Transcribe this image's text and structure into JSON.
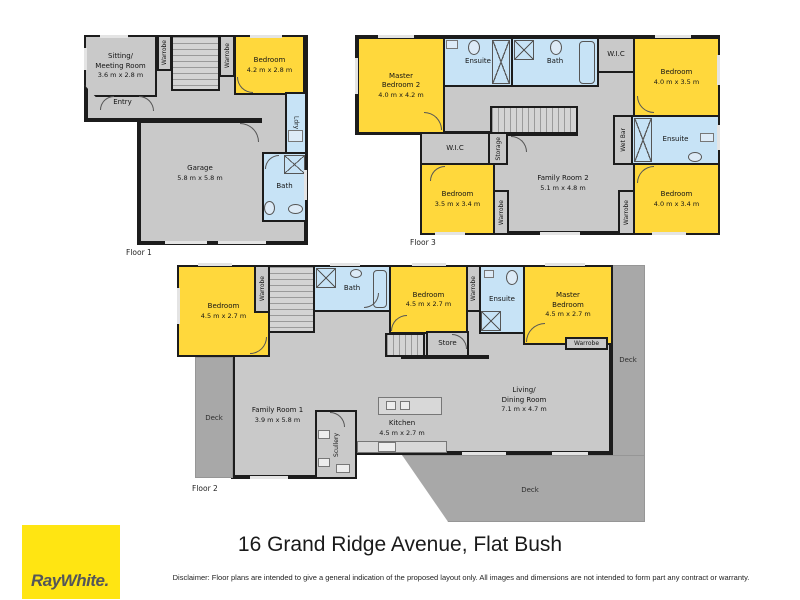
{
  "title": "16 Grand Ridge Avenue, Flat Bush",
  "disclaimer": "Disclaimer: Floor plans are intended to give a general indication of the proposed layout only. All images and dimensions are not intended to form part any contract or warranty.",
  "brand": {
    "logo_text": "RayWhite."
  },
  "colors": {
    "bedroom_yellow": "#FFD83C",
    "bath_blue": "#C7E3F6",
    "room_gray": "#C9C9C9",
    "deck_gray": "#A8A8A8",
    "wall_black": "#1C1C1C",
    "logo_yellow": "#FFE512",
    "logo_text_gray": "#54565A"
  },
  "floors": [
    {
      "label": "Floor 1",
      "rooms": {
        "sitting": {
          "name": "Sitting/\nMeeting Room",
          "dims": "3.6 m x 2.8 m"
        },
        "wardrobe_a": {
          "name": "Warrobe"
        },
        "wardrobe_b": {
          "name": "Warrobe"
        },
        "bedroom": {
          "name": "Bedroom",
          "dims": "4.2 m x 2.8 m"
        },
        "entry": {
          "name": "Entry"
        },
        "laundry": {
          "name": "Ldry"
        },
        "garage": {
          "name": "Garage",
          "dims": "5.8 m x 5.8 m"
        },
        "bath": {
          "name": "Bath"
        }
      }
    },
    {
      "label": "Floor 2",
      "rooms": {
        "bedroom_left": {
          "name": "Bedroom",
          "dims": "4.5 m x 2.7 m"
        },
        "wardrobe_left": {
          "name": "Warrobe"
        },
        "bath": {
          "name": "Bath"
        },
        "bedroom_mid": {
          "name": "Bedroom",
          "dims": "4.5 m x 2.7 m"
        },
        "wardrobe_mid": {
          "name": "Warrobe"
        },
        "ensuite": {
          "name": "Ensuite"
        },
        "master_bedroom": {
          "name": "Master\nBedroom",
          "dims": "4.5 m x 2.7 m"
        },
        "wardrobe_master": {
          "name": "Warrobe"
        },
        "store": {
          "name": "Store"
        },
        "family_room": {
          "name": "Family Room 1",
          "dims": "3.9 m x 5.8 m"
        },
        "scullery": {
          "name": "Scullery"
        },
        "kitchen": {
          "name": "Kitchen",
          "dims": "4.5 m x 2.7 m"
        },
        "living": {
          "name": "Living/\nDining Room",
          "dims": "7.1 m x 4.7 m"
        },
        "deck_left": {
          "name": "Deck"
        },
        "deck_right": {
          "name": "Deck"
        },
        "deck_bottom": {
          "name": "Deck"
        }
      }
    },
    {
      "label": "Floor 3",
      "rooms": {
        "master_bedroom_2": {
          "name": "Master\nBedroom 2",
          "dims": "4.0 m x 4.2 m"
        },
        "ensuite_top": {
          "name": "Ensuite"
        },
        "bath": {
          "name": "Bath"
        },
        "wic_top": {
          "name": "W.I.C"
        },
        "bedroom_top_right": {
          "name": "Bedroom",
          "dims": "4.0 m x 3.5 m"
        },
        "wic_left": {
          "name": "W.I.C"
        },
        "storage": {
          "name": "Storage"
        },
        "wet_bar": {
          "name": "Wet Bar"
        },
        "ensuite_right": {
          "name": "Ensuite"
        },
        "family_room_2": {
          "name": "Family Room 2",
          "dims": "5.1 m x 4.8 m"
        },
        "bedroom_mid_left": {
          "name": "Bedroom",
          "dims": "3.5 m x 3.4 m"
        },
        "wardrobe_mid": {
          "name": "Warrobe"
        },
        "bedroom_bottom_right": {
          "name": "Bedroom",
          "dims": "4.0 m x 3.4 m"
        },
        "wardrobe_right": {
          "name": "Warrobe"
        }
      }
    }
  ]
}
